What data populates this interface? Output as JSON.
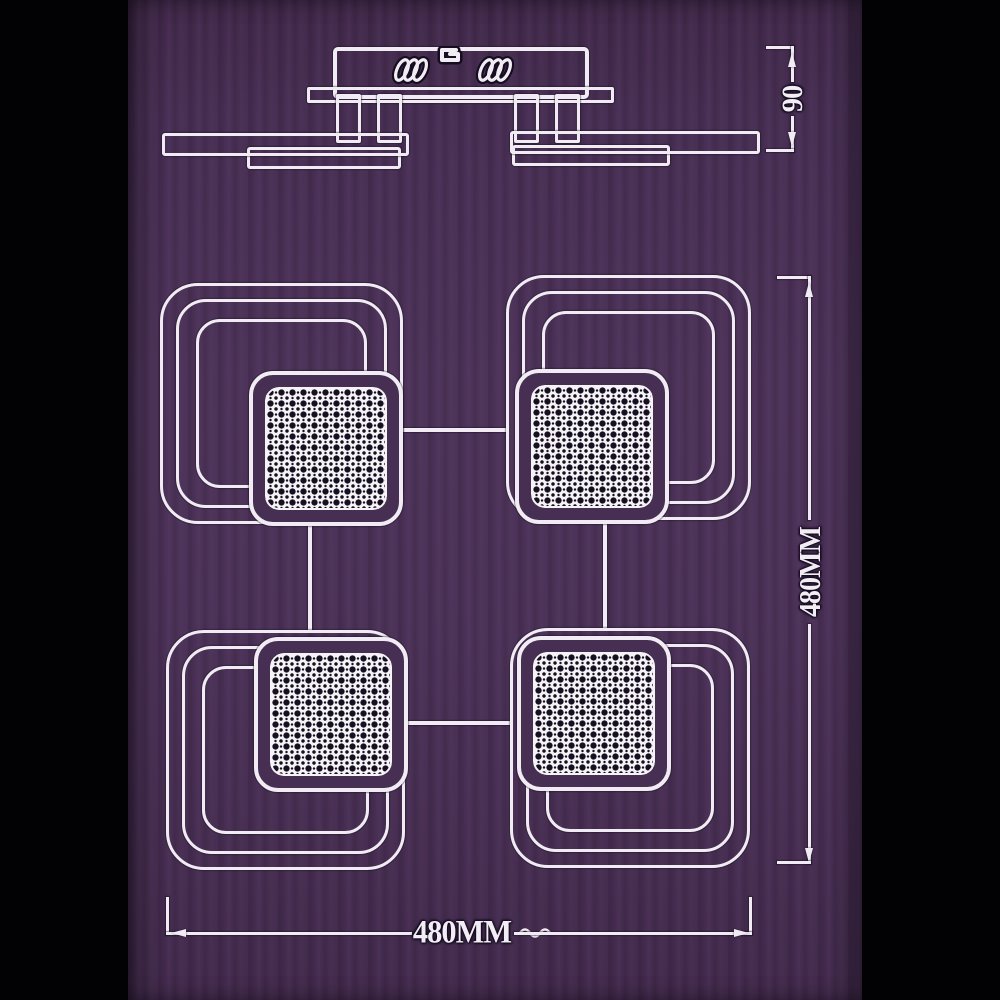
{
  "diagram": {
    "side_view": {
      "height_dimension": "90"
    },
    "top_view": {
      "width_dimension": "480MM",
      "height_dimension": "480MM"
    },
    "colors": {
      "background": "#4b3157",
      "side_bars": "#000000",
      "line": "#f1ecf3",
      "mesh_dot": "#171021"
    }
  }
}
